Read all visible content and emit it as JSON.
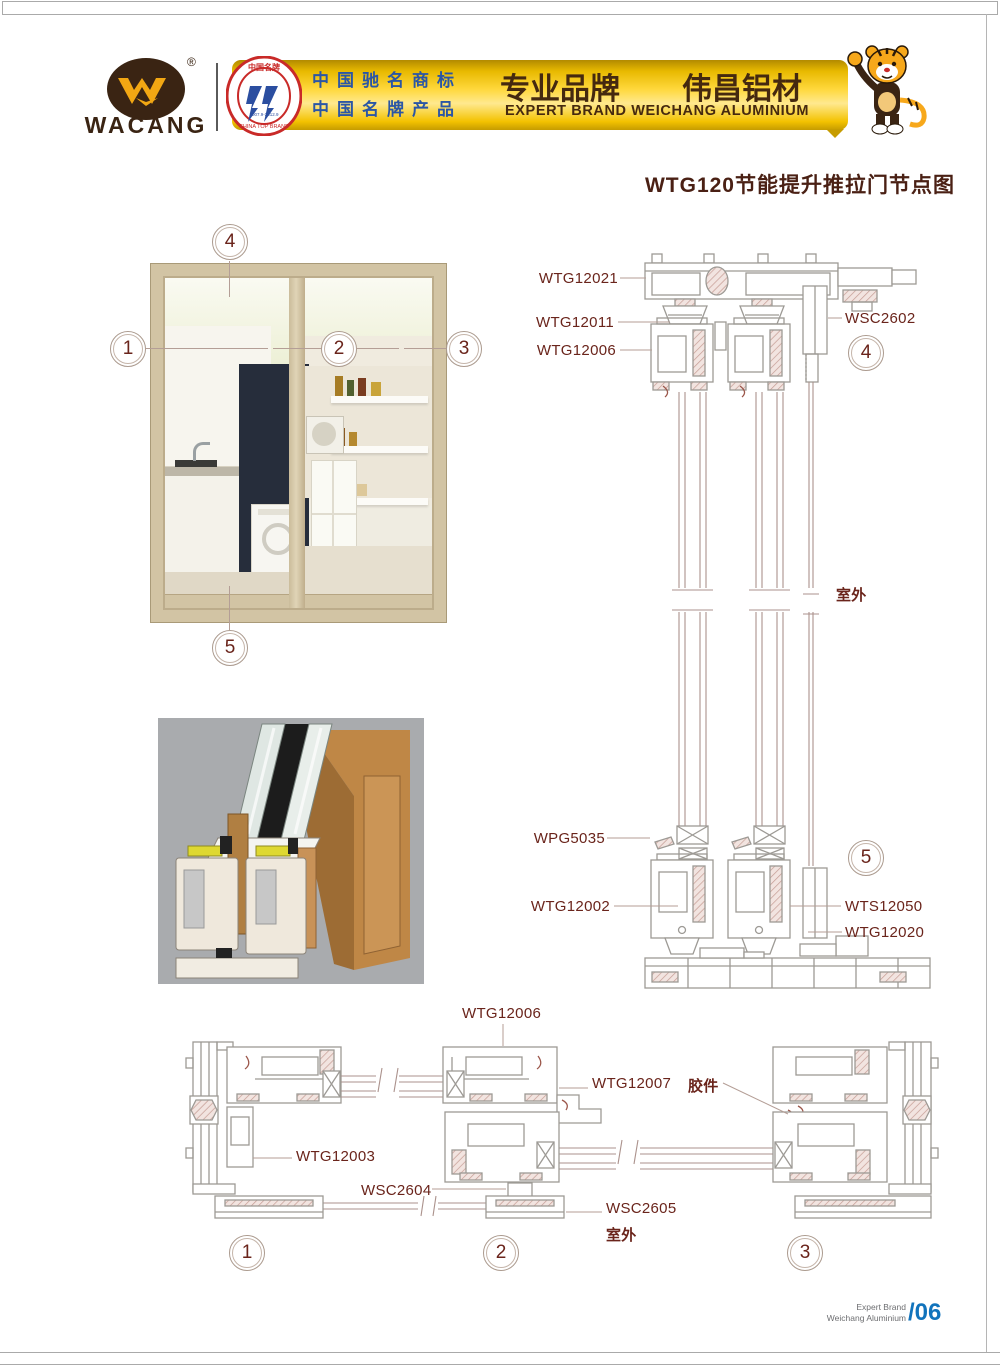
{
  "header": {
    "logo_text": "WACANG",
    "logo_reg": "®",
    "badge_top": "中国名牌",
    "badge_years": "2007.9-2012.9",
    "badge_bottom": "CHINA TOP BRAND",
    "cn_line1": "中国驰名商标",
    "cn_line2": "中国名牌产品",
    "brand_cn_left": "专业品牌",
    "brand_cn_right": "伟昌铝材",
    "brand_en": "EXPERT BRAND WEICHANG ALUMINIUM"
  },
  "title": "WTG120节能提升推拉门节点图",
  "callouts": {
    "c1": "1",
    "c2": "2",
    "c3": "3",
    "c4": "4",
    "c5": "5"
  },
  "labels": {
    "wtg12021": "WTG12021",
    "wtg12011": "WTG12011",
    "wtg12006_top": "WTG12006",
    "wsc2602": "WSC2602",
    "wpg5035": "WPG5035",
    "wtg12002": "WTG12002",
    "wts12050": "WTS12050",
    "wtg12020": "WTG12020",
    "wtg12006_bottom": "WTG12006",
    "wtg12007": "WTG12007",
    "jiaojian": "胶件",
    "wtg12003": "WTG12003",
    "wsc2604": "WSC2604",
    "wsc2605": "WSC2605",
    "outdoor_right": "室外",
    "outdoor_bottom": "室外"
  },
  "footer": {
    "line1": "Expert Brand",
    "line2": "Weichang Aluminium",
    "page": "/06"
  },
  "colors": {
    "accent_maroon": "#6a241b",
    "banner_gold": "#ffd83d",
    "banner_text_blue": "#2b56a5",
    "brand_brown": "#45290f",
    "drawing_gray": "#9d9a95",
    "drawing_rose": "#c59c94",
    "footer_blue": "#1173bc"
  }
}
